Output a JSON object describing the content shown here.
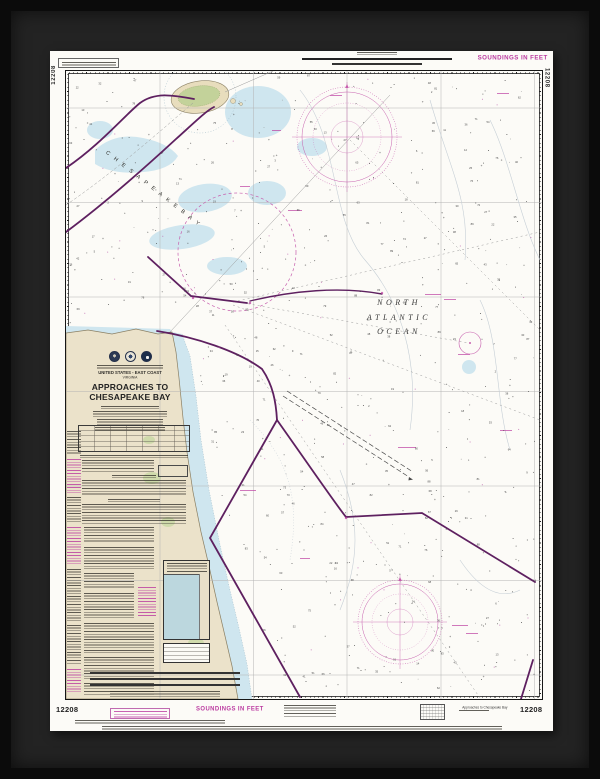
{
  "chart": {
    "number": "12208",
    "soundings_note": "SOUNDINGS IN FEET",
    "title_block": {
      "country_line": "UNITED STATES - EAST COAST",
      "state_line": "VIRGINIA",
      "title_line1": "APPROACHES TO",
      "title_line2": "CHESAPEAKE BAY"
    },
    "water_labels": {
      "bay": "C H E S A P E A K E   B A Y",
      "ocean_line1": "NORTH",
      "ocean_line2": "ATLANTIC",
      "ocean_line3": "OCEAN"
    },
    "footer": {
      "small_title": "Approaches to Chesapeake Bay"
    },
    "colors": {
      "magenta": "#bb3ba0",
      "traffic_lane_purple": "#5e2060",
      "land_tan": "#ebe2ca",
      "shallow_blue": "#cfe6ef",
      "marsh_green": "#cddaa8",
      "frame_black": "#0b0b0b",
      "mat_gray": "#232323",
      "paper_white": "#fcfbf7"
    }
  }
}
